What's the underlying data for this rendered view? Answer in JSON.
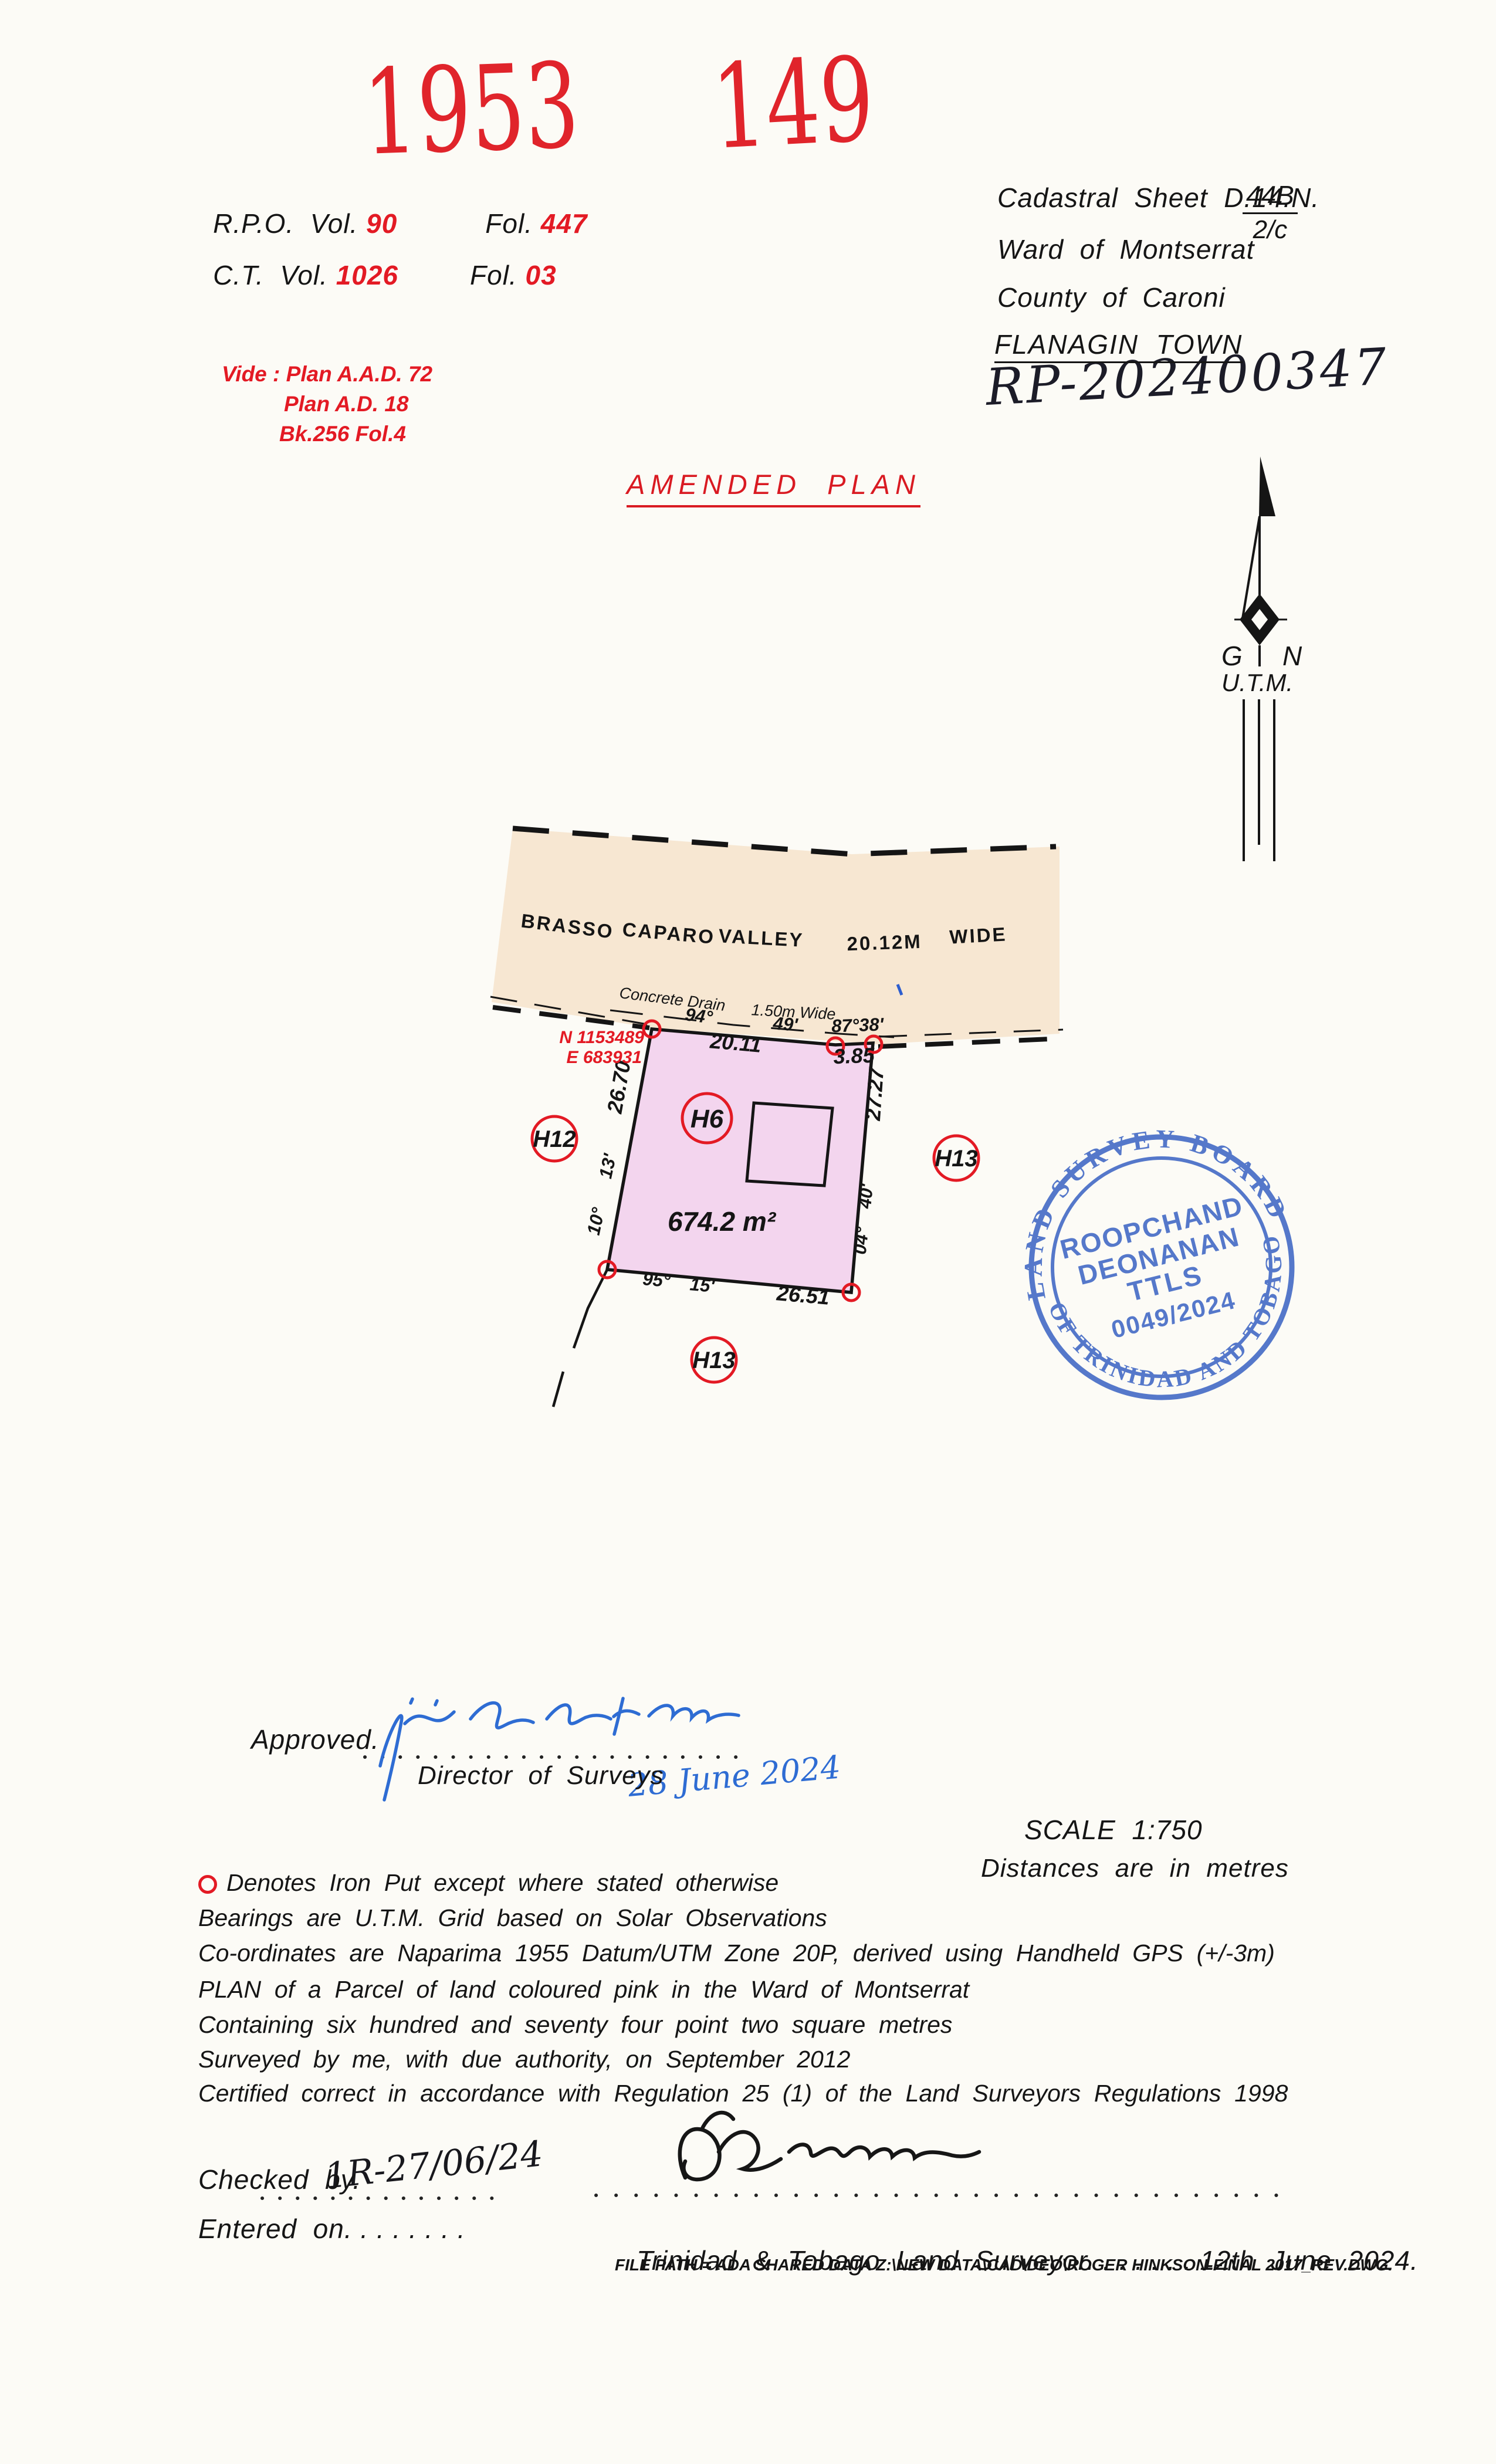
{
  "colors": {
    "accent_red": "#e31a24",
    "stamp_blue": "#3f66c4",
    "ink_blue": "#2e6cd3",
    "road_fill": "#f7e7d2",
    "parcel_fill": "#f3d5ee",
    "line_black": "#151515"
  },
  "stamps_top": {
    "year": "1953",
    "number": "149"
  },
  "refs": {
    "rpo_label": "R.P.O.  Vol.",
    "rpo_vol": "90",
    "fol_label": "Fol.",
    "rpo_fol": "447",
    "ct_label": "C.T.  Vol.",
    "ct_vol": "1026",
    "ct_fol": "03"
  },
  "cadastral": {
    "sheet_label": "Cadastral  Sheet  D.14.N.",
    "sheet_no": "44B",
    "sheet_sub": "2/c",
    "ward": "Ward  of  Montserrat",
    "county": "County  of  Caroni",
    "town": "FLANAGIN  TOWN",
    "rp_number": "RP-202400347"
  },
  "vide": {
    "line1": "Vide : Plan  A.A.D.  72",
    "line2": "Plan  A.D.  18",
    "line3": "Bk.256  Fol.4"
  },
  "amended": {
    "title": "AMENDED  PLAN"
  },
  "north": {
    "g": "G",
    "n": "N",
    "utm": "U.T.M."
  },
  "road": {
    "name1": "BRASSO",
    "name2": "CAPARO",
    "name3": "VALLEY",
    "width_value": "20.12M",
    "width_word": "WIDE",
    "drain1": "Concrete  Drain",
    "drain2": "1.50m  Wide"
  },
  "parcel": {
    "lot": "H6",
    "area": "674.2  m²",
    "coord_n": "N 1153489",
    "coord_e": "E  683931",
    "brg_top_deg": "94°",
    "brg_top_min": "49'",
    "brg_top_right": "87°38'",
    "dist_top": "20.11",
    "dist_top_right": "3.85",
    "dist_left": "26.70",
    "brg_left_min": "13'",
    "brg_left_deg": "10°",
    "dist_right": "27.27",
    "brg_right_min": "40'",
    "brg_right_deg": "04°",
    "brg_bottom_deg": "95°",
    "brg_bottom_min": "15'",
    "dist_bottom": "26.51",
    "neighbour_left": "H12",
    "neighbour_right": "H13",
    "neighbour_bottom": "H13"
  },
  "board_stamp": {
    "arc_top": "LAND SURVEY BOARD",
    "arc_bottom": "OF TRINIDAD AND TOBAGO",
    "line1": "ROOPCHAND",
    "line2": "DEONANAN",
    "line3": "TTLS",
    "line4": "0049/2024"
  },
  "approval": {
    "label": "Approved.",
    "title": "Director  of  Surveys",
    "date_hand": "28 June 2024"
  },
  "scale_block": {
    "scale": "SCALE  1:750",
    "units": "Distances  are  in  metres"
  },
  "notes": {
    "n1": "Denotes  Iron  Put  except  where  stated  otherwise",
    "n2": "Bearings  are  U.T.M.  Grid  based  on  Solar  Observations",
    "n3": "Co-ordinates  are  Naparima  1955  Datum/UTM  Zone  20P,  derived  using  Handheld  GPS  (+/-3m)",
    "n4": "PLAN  of  a  Parcel  of  land  coloured  pink  in  the  Ward  of  Montserrat",
    "n5": "Containing  six  hundred  and  seventy  four  point  two  square  metres",
    "n6": "Surveyed  by  me,  with  due  authority,  on  September  2012",
    "n7": "Certified  correct  in  accordance  with  Regulation  25  (1)  of  the  Land  Surveyors  Regulations  1998"
  },
  "footer": {
    "checked_label": "Checked  by.",
    "checked_hand": "1R-27/06/24",
    "entered": "Entered  on. . . . . . . .",
    "surveyor_line": "Trinidad  &  Tobago  Land  Surveyor. . . . . . .",
    "survey_date": " 12th  June  2024.",
    "file_path": "FILE PATH = ADA SHARED DATA Z:\\NEW DATA\\CAD\\DEO\\ROGER HINKSON-FINAL 2017_REV.DWG."
  }
}
